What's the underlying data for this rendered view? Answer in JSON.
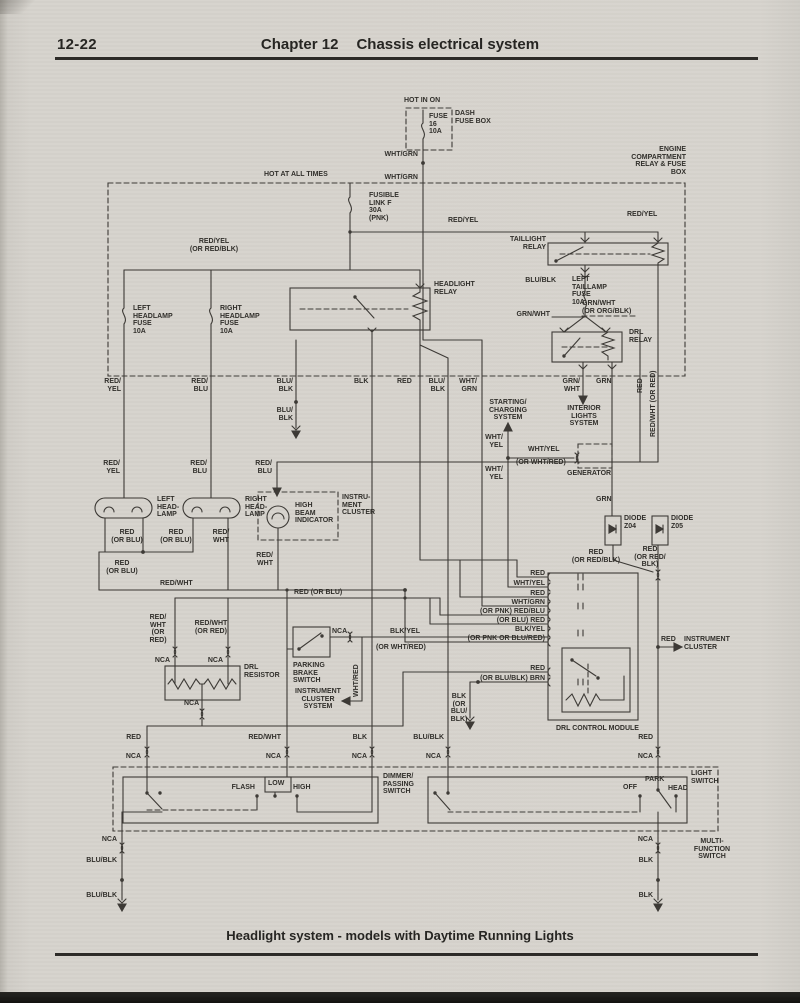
{
  "header": {
    "page_number": "12-22",
    "chapter": "Chapter 12",
    "title": "Chassis electrical system"
  },
  "footer": {
    "caption": "Headlight system - models with Daytime Running Lights"
  },
  "colors": {
    "paper": "#d6d3cd",
    "ink": "#3a3733",
    "text": "#2e2c28"
  },
  "labels": {
    "hot_in_on": "HOT IN ON",
    "dash_fuse": "FUSE\n16\n10A",
    "dash_fuse_box": "DASH\nFUSE BOX",
    "wht_grn_1": "WHT/GRN",
    "wht_grn_2": "WHT/GRN",
    "hot_at_all_times": "HOT AT ALL TIMES",
    "engine_box": "ENGINE\nCOMPARTMENT\nRELAY & FUSE\nBOX",
    "fusible_link": "FUSIBLE\nLINK F\n30A\n(PNK)",
    "red_yel_feed": "RED/YEL",
    "red_yel_right": "RED/YEL",
    "red_yel_alt": "RED/YEL\n(OR RED/BLK)",
    "taillight_relay": "TAILLIGHT\nRELAY",
    "left_headlamp_fuse": "LEFT\nHEADLAMP\nFUSE\n10A",
    "right_headlamp_fuse": "RIGHT\nHEADLAMP\nFUSE\n10A",
    "headlight_relay": "HEADLIGHT\nRELAY",
    "blu_blk_tail": "BLU/BLK",
    "left_taillamp_fuse": "LEFT\nTAILLAMP\nFUSE\n10A",
    "grn_wht_alt": "GRN/WHT\n(OR ORG/BLK)",
    "grn_wht_left": "GRN/WHT",
    "drl_relay": "DRL\nRELAY",
    "col_red_yel": "RED/\nYEL",
    "col_red_blu": "RED/\nBLU",
    "col_blu_blk": "BLU/\nBLK",
    "col_blk": "BLK",
    "col_red": "RED",
    "col_blu_blk2": "BLU/\nBLK",
    "col_wht_grn": "WHT/\nGRN",
    "col_grn_wht": "GRN/\nWHT",
    "col_grn": "GRN",
    "col_red_vert": "RED",
    "col_red_wht_vert": "RED/WHT (OR RED)",
    "blu_blk_gnd": "BLU/\nBLK",
    "starting_charging": "STARTING/\nCHARGING\nSYSTEM",
    "wht_yel_1": "WHT/\nYEL",
    "wht_yel_2": "WHT/\nYEL",
    "wht_yel_gen": "WHT/YEL",
    "wht_yel_gen_alt": "(OR WHT/RED)",
    "generator": "GENERATOR",
    "interior_lights": "INTERIOR\nLIGHTS\nSYSTEM",
    "lamp_red_yel": "RED/\nYEL",
    "lamp_red_blu": "RED/\nBLU",
    "ind_red_blu": "RED/\nBLU",
    "left_headlamp": "LEFT\nHEAD-\nLAMP",
    "right_headlamp": "RIGHT\nHEAD-\nLAMP",
    "high_beam": "HIGH\nBEAM\nINDICATOR",
    "instrument_cluster_1": "INSTRU-\nMENT\nCLUSTER",
    "grn_mid": "GRN",
    "diode_z04": "DIODE\nZ04",
    "diode_z05": "DIODE\nZ05",
    "red_rb_1": "RED\n(OR RED/BLK)",
    "red_rb_2": "RED\n(OR RED/\nBLK)",
    "red_ob_1": "RED\n(OR BLU)",
    "red_ob_2": "RED\n(OR BLU)",
    "red_ob_3": "RED\n(OR BLU)",
    "red_wht_p": "RED/\nWHT",
    "red_wht_ind": "RED/\nWHT",
    "red_wht_h": "RED/WHT",
    "red_ob_h": "RED (OR BLU)",
    "res_feed_1": "RED/\nWHT\n(OR\nRED)",
    "res_feed_2": "RED/WHT\n(OR RED)",
    "nca_res_1": "NCA",
    "nca_res_2": "NCA",
    "nca_res_3": "NCA",
    "drl_resistor": "DRL\nRESISTOR",
    "parking_brake": "PARKING\nBRAKE\nSWITCH",
    "nca_pb": "NCA",
    "wht_red_vert": "WHT/RED",
    "ics_system": "INSTRUMENT\nCLUSTER\nSYSTEM",
    "blk_yel_pb": "BLK/YEL",
    "blk_yel_pb_alt": "(OR WHT/RED)",
    "mi_1": "RED",
    "mi_2": "WHT/YEL",
    "mi_3": "RED",
    "mi_4": "WHT/GRN",
    "mi_5": "(OR PNK) RED/BLU",
    "mi_6": "(OR BLU) RED",
    "mi_7": "BLK/YEL",
    "mi_8": "(OR PNK OR BLU/RED)",
    "mi_9": "RED",
    "mi_10": "(OR BLU/BLK) BRN",
    "blk_gnd_stack": "BLK\n(OR\nBLU/\nBLK)",
    "drl_module": "DRL CONTROL MODULE",
    "red_ic": "RED",
    "instrument_cluster_2": "INSTRUMENT\nCLUSTER",
    "red_dim": "RED",
    "red_wht_dim": "RED/WHT",
    "blk_dim": "BLK",
    "blu_blk_lsw": "BLU/BLK",
    "red_lsw": "RED",
    "nca_b1": "NCA",
    "nca_b2": "NCA",
    "nca_b3": "NCA",
    "nca_b4": "NCA",
    "nca_b5": "NCA",
    "dimmer_switch": "DIMMER/\nPASSING\nSWITCH",
    "flash": "FLASH",
    "low": "LOW",
    "high": "HIGH",
    "light_switch": "LIGHT\nSWITCH",
    "off": "OFF",
    "park": "PARK",
    "head": "HEAD",
    "multi_function": "MULTI-\nFUNCTION\nSWITCH",
    "nca_g1": "NCA",
    "nca_g2": "NCA",
    "blu_blk_g1": "BLU/BLK",
    "blu_blk_g2": "BLU/BLK",
    "blk_g1": "BLK",
    "blk_g2": "BLK"
  }
}
